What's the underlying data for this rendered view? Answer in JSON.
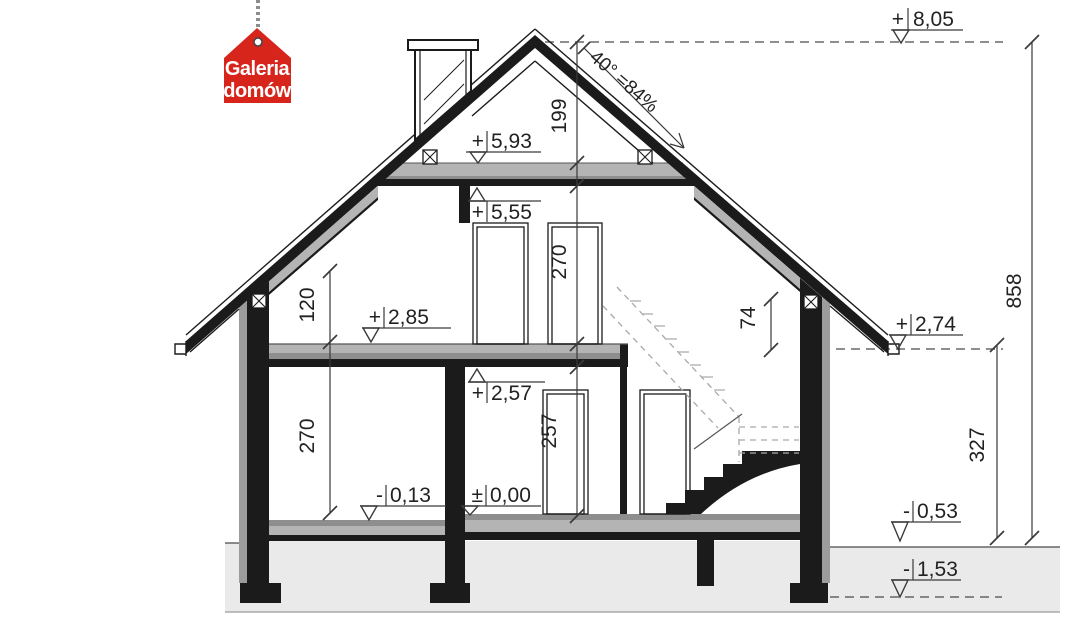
{
  "logo": {
    "line1": "Galeria",
    "line2": "domów",
    "bg_color": "#d8251c",
    "text_color": "#ffffff"
  },
  "levels": {
    "l805": {
      "sign": "+",
      "value": "8,05"
    },
    "l593": {
      "sign": "+",
      "value": "5,93"
    },
    "l555": {
      "sign": "+",
      "value": "5,55"
    },
    "l285": {
      "sign": "+",
      "value": "2,85"
    },
    "l274": {
      "sign": "+",
      "value": "2,74"
    },
    "l257": {
      "sign": "+",
      "value": "2,57"
    },
    "l000": {
      "sign": "±",
      "value": "0,00"
    },
    "l013": {
      "sign": "-",
      "value": "0,13"
    },
    "l053": {
      "sign": "-",
      "value": "0,53"
    },
    "l153": {
      "sign": "-",
      "value": "1,53"
    }
  },
  "dimensions": {
    "ridge_to_collar": "199",
    "attic_room_height": "270",
    "ground_ceiling_height": "257",
    "knee_wall_height": "120",
    "ground_room_height": "270",
    "eave_above_knee": "74",
    "total_height": "858",
    "eave_above_ground": "327"
  },
  "roof": {
    "pitch_label": "40° =84%"
  },
  "colors": {
    "line": "#1b1b1b",
    "insulation_gray": "#b4b4b4",
    "screed_gray": "#8e8e8e",
    "terrain_gray": "#eaeaea",
    "logo_red": "#d8251c"
  }
}
